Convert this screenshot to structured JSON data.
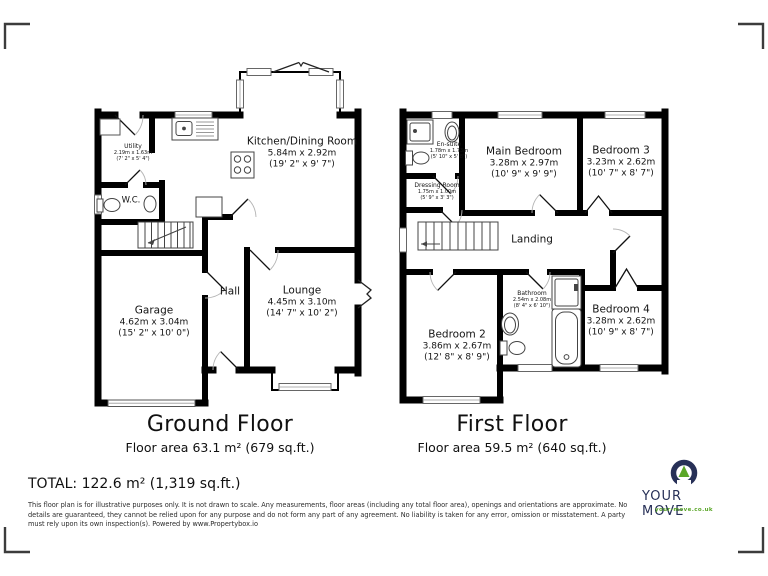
{
  "footer": {
    "total": "TOTAL: 122.6 m² (1,319 sq.ft.)",
    "disclaimer": "This floor plan is for illustrative purposes only. It is not drawn to scale. Any measurements, floor areas (including any total floor area), openings and orientations are approximate. No details are guaranteed, they cannot be relied upon for any purpose and do not form any part of any agreement. No liability is taken for any error, omission or misstatement. A party must rely upon its own inspection(s). Powered by www.Propertybox.io"
  },
  "logo": {
    "brand": "YOUR MOVE",
    "url": "your-move.co.uk",
    "navy": "#273057",
    "green": "#5aa628"
  },
  "ground_floor": {
    "title": "Ground Floor",
    "area": "Floor area 63.1 m² (679 sq.ft.)",
    "rooms": {
      "utility": {
        "name": "Utility",
        "metric": "2.19m x 1.63m",
        "imperial": "(7' 2\" x 5' 4\")"
      },
      "wc": {
        "name": "W.C."
      },
      "kitchen": {
        "name": "Kitchen/Dining Room",
        "metric": "5.84m x 2.92m",
        "imperial": "(19' 2\" x 9' 7\")"
      },
      "hall": {
        "name": "Hall"
      },
      "garage": {
        "name": "Garage",
        "metric": "4.62m x 3.04m",
        "imperial": "(15' 2\" x 10' 0\")"
      },
      "lounge": {
        "name": "Lounge",
        "metric": "4.45m x 3.10m",
        "imperial": "(14' 7\" x 10' 2\")"
      }
    }
  },
  "first_floor": {
    "title": "First Floor",
    "area": "Floor area 59.5 m² (640 sq.ft.)",
    "rooms": {
      "ensuite": {
        "name": "En-suite",
        "metric": "1.78m x 1.73m",
        "imperial": "(5' 10\" x 5' 8\")"
      },
      "main_bedroom": {
        "name": "Main Bedroom",
        "metric": "3.28m x 2.97m",
        "imperial": "(10' 9\" x 9' 9\")"
      },
      "bedroom3": {
        "name": "Bedroom 3",
        "metric": "3.23m x 2.62m",
        "imperial": "(10' 7\" x 8' 7\")"
      },
      "dressing": {
        "name": "Dressing Room",
        "metric": "1.75m x 1.00m",
        "imperial": "(5' 9\" x 3' 3\")"
      },
      "landing": {
        "name": "Landing"
      },
      "bedroom2": {
        "name": "Bedroom 2",
        "metric": "3.86m x 2.67m",
        "imperial": "(12' 8\" x 8' 9\")"
      },
      "bathroom": {
        "name": "Bathroom",
        "metric": "2.54m x 2.08m",
        "imperial": "(8' 4\" x 6' 10\")"
      },
      "bedroom4": {
        "name": "Bedroom 4",
        "metric": "3.28m x 2.62m",
        "imperial": "(10' 9\" x 8' 7\")"
      }
    }
  }
}
